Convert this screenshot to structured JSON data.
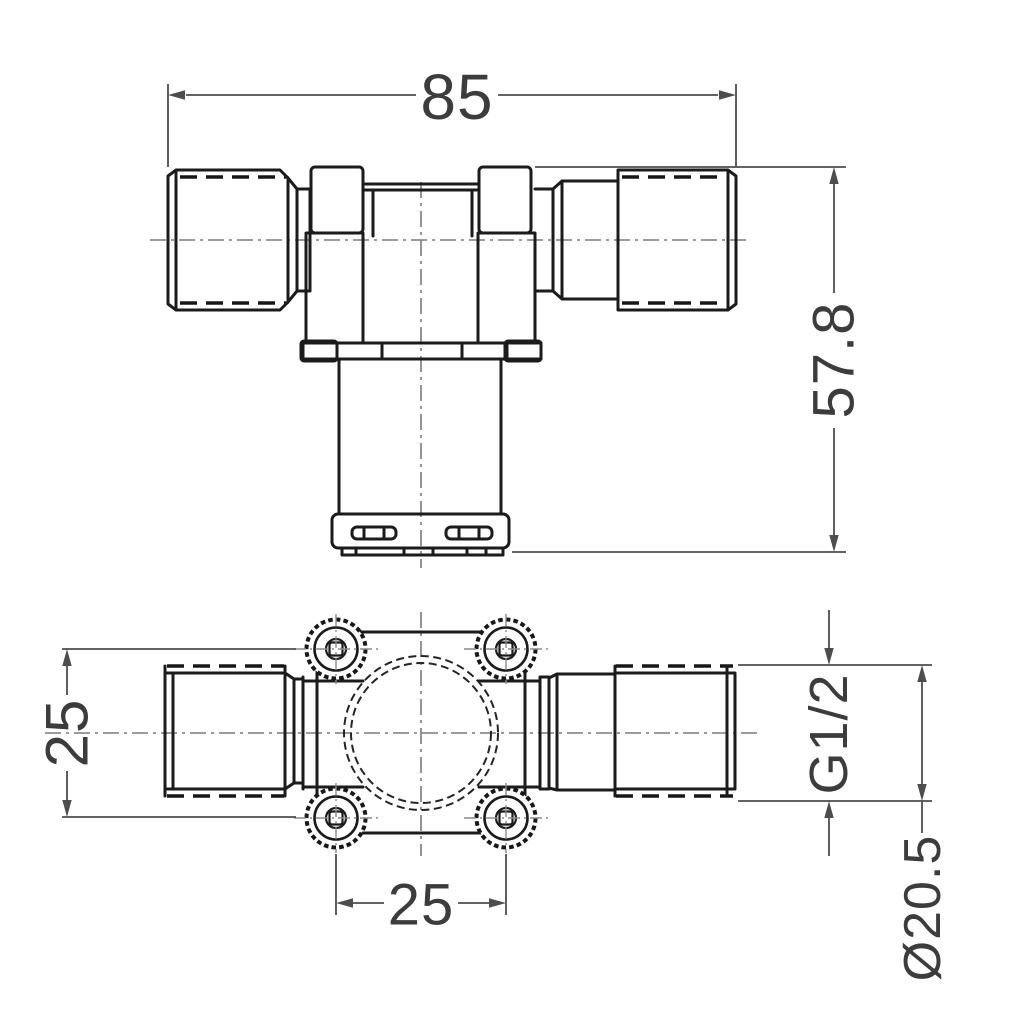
{
  "drawing_type": "technical-2-view-engineering-drawing",
  "dimensions": {
    "overall_width": "85",
    "overall_height": "57.8",
    "port_center_offset": "25",
    "mounting_hole_spacing": "25",
    "thread_size": "G1/2",
    "outlet_diameter": "Ø20.5"
  },
  "colors": {
    "background": "#ffffff",
    "object_line": "#1b1b1b",
    "dimension_line": "#4d4d4d",
    "centerline": "#7a7a7a",
    "text": "#3c3c3c"
  }
}
